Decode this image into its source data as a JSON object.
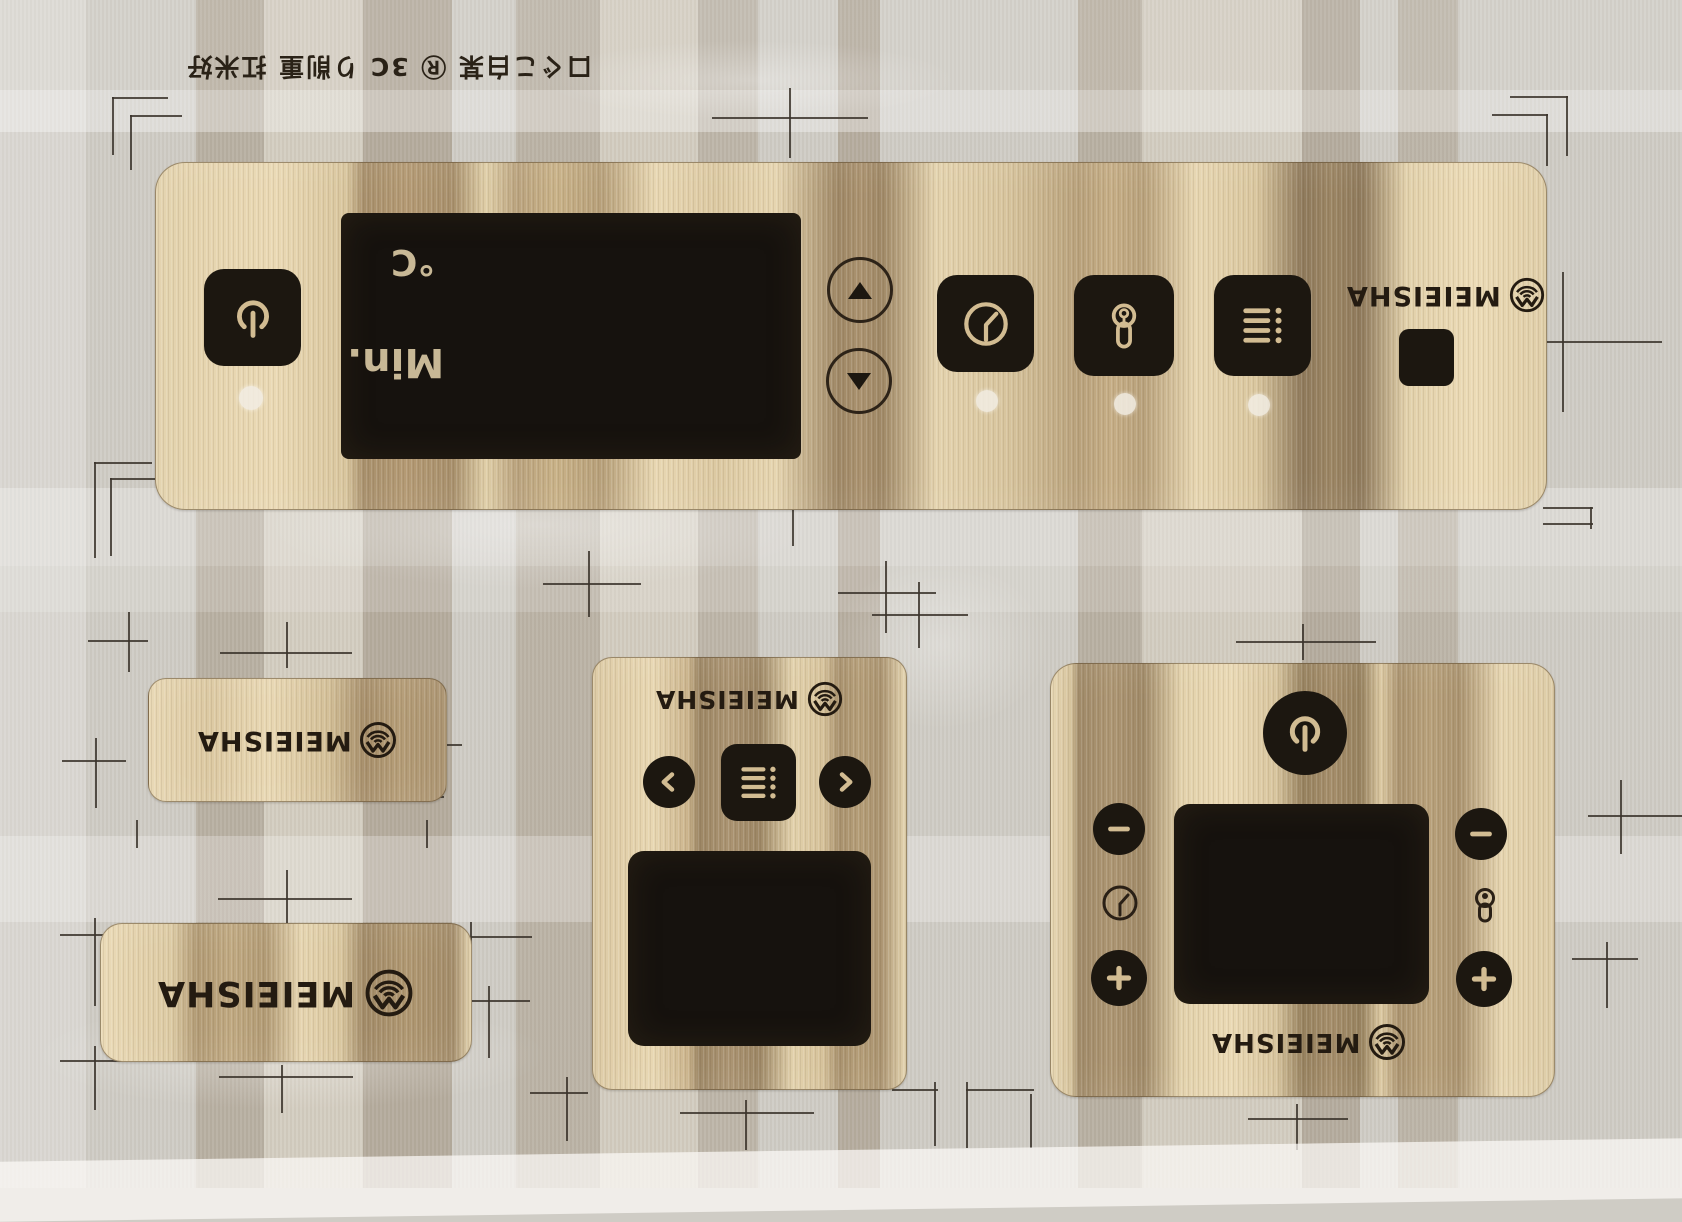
{
  "brand": "MEIEISHA",
  "sheet": {
    "description": "clear film sheet of printed gold membrane control-panel decals, all artwork printed upside down",
    "top_marking": {
      "text": "口ぐこ白某 Ⓡ 3C り削重 扛米好",
      "orientation": "upside down"
    }
  },
  "colors": {
    "film": "#cfccc5",
    "panel_gold_light": "#ead9b4",
    "panel_gold_dark": "#97825f",
    "ink_black": "#1c1710",
    "icon_gold": "#d2bc92",
    "registration_mark": "#3b342b",
    "display_black": "#16120e"
  },
  "main_panel": {
    "logo": "MEIEISHA",
    "display": {
      "temp_unit": "°C",
      "minutes_label": "Min."
    },
    "buttons": {
      "power": "power-icon",
      "up": "triangle-up",
      "down": "triangle-down",
      "timer": "clock-icon",
      "lock": "key-icon",
      "menu": "menu-list-icon"
    },
    "indicator_dots": 4,
    "blank_chip": "black square window"
  },
  "small_label": {
    "logo": "MEIEISHA"
  },
  "large_label": {
    "logo": "MEIEISHA"
  },
  "center_panel": {
    "logo": "MEIEISHA",
    "buttons": {
      "prev": "chevron-left",
      "menu": "menu-list-icon",
      "next": "chevron-right"
    },
    "display": "black display window"
  },
  "right_panel": {
    "logo": "MEIEISHA",
    "buttons": {
      "power": "power-icon",
      "minus": "minus",
      "plus": "plus"
    },
    "icons": {
      "timer": "clock-icon",
      "lock": "keyhole-icon"
    },
    "display": "black display window"
  }
}
